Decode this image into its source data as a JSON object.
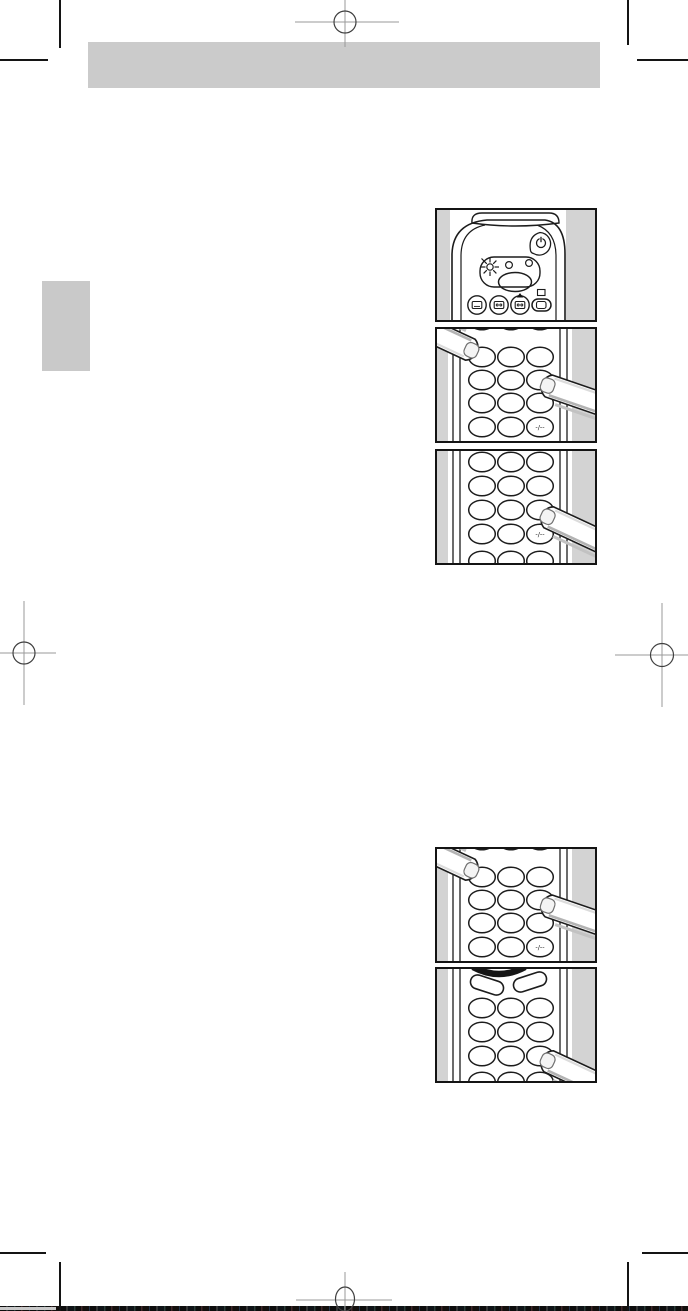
{
  "page": {
    "background": "#ffffff",
    "ink_color": "#1c1c1c",
    "header_bar_color": "#cbcbcb",
    "side_tab_color": "#c9c9c9",
    "figure_backdrop_color": "#d3d3d3",
    "registration_mark_color": "#9a9a9a",
    "crop_mark_color": "#141414"
  },
  "figures": {
    "fig1": {
      "name": "remote-control-top-view",
      "icons": [
        "power-icon",
        "led-blink-icon",
        "tv-select-icon",
        "vcr-select-icon",
        "sat-select-icon",
        "eject-triangle-icon",
        "screen-square-icon",
        "aux-select-icon"
      ]
    },
    "fig2": {
      "name": "keypad-two-fingers-pressing",
      "digit_button_label": "-/--"
    },
    "fig3": {
      "name": "keypad-one-finger-pressing",
      "digit_button_label": "-/--"
    },
    "fig4": {
      "name": "keypad-two-fingers-pressing",
      "digit_button_label": "-/--"
    },
    "fig5": {
      "name": "keypad-rocker-keys-one-finger",
      "digit_button_label": "-/--"
    }
  }
}
